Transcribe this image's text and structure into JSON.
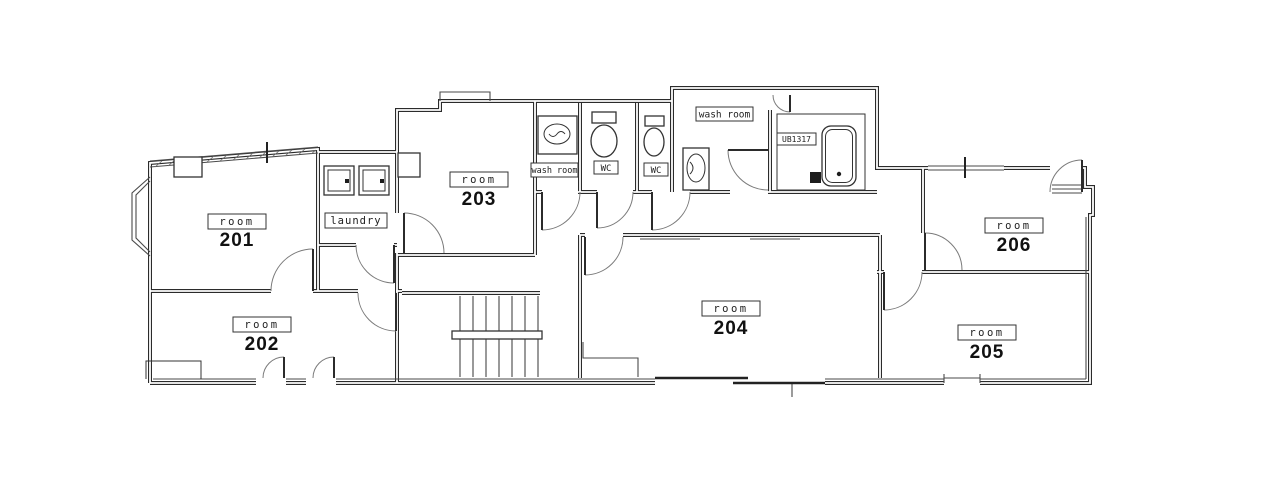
{
  "plan": {
    "type": "architectural-floor-plan",
    "rooms": [
      {
        "label": "room",
        "number": "201"
      },
      {
        "label": "room",
        "number": "202"
      },
      {
        "label": "room",
        "number": "203"
      },
      {
        "label": "room",
        "number": "204"
      },
      {
        "label": "room",
        "number": "205"
      },
      {
        "label": "room",
        "number": "206"
      }
    ],
    "facilities": {
      "laundry": "laundry",
      "wash_room_small": "wash room",
      "wash_room_large": "wash room",
      "wc_a": "WC",
      "wc_b": "WC",
      "unit_bath": "UB1317"
    },
    "fixtures": [
      "washing-machine",
      "washing-machine",
      "wash-basin",
      "toilet",
      "toilet",
      "wash-basin",
      "bathtub",
      "staircase"
    ],
    "colors": {
      "background": "#ffffff",
      "wall_line": "#2b2b2b",
      "detail_line": "#4a4a4a",
      "text": "#111111"
    }
  }
}
